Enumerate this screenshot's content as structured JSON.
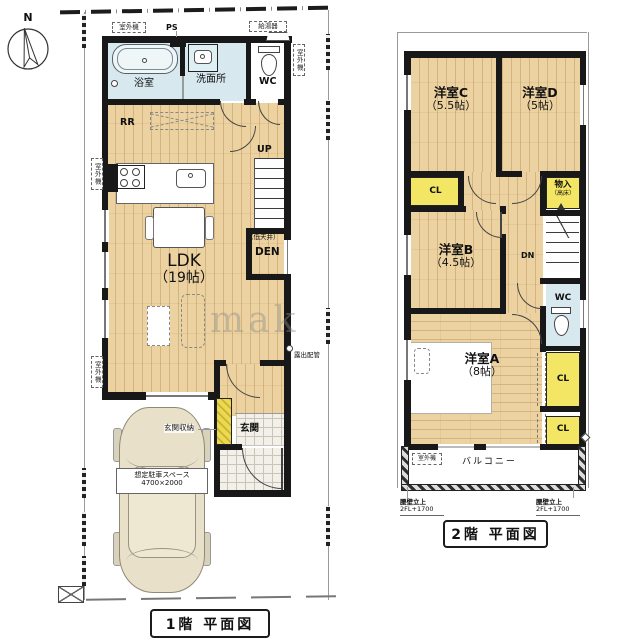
{
  "compass": {
    "north_label": "N"
  },
  "watermark": "mak",
  "colors": {
    "wall": "#181818",
    "wood_floor": "#ecd2a0",
    "wet_area": "#d7e9ef",
    "closet": "#f3e664",
    "tile": "#f2f0e8"
  },
  "floor1": {
    "title": "1階 平面図",
    "rooms": {
      "bath": "浴室",
      "washroom": "洗面所",
      "wc": "WC",
      "ldk_line1": "LDK",
      "ldk_line2": "（19帖）",
      "den": "DEN",
      "den_note": "（低天井）",
      "rr": "RR",
      "up": "UP",
      "genkan": "玄関",
      "genkan_storage": "玄関収納"
    },
    "annotations": {
      "ps": "PS",
      "water_heater": "給湯器",
      "outdoor_unit": "室外機",
      "exposed_pipe": "露出配管",
      "parking_line1": "想定駐車スペース",
      "parking_line2": "4700×2000"
    }
  },
  "floor2": {
    "title": "2階 平面図",
    "rooms": {
      "room_c_line1": "洋室C",
      "room_c_line2": "（5.5帖）",
      "room_d_line1": "洋室D",
      "room_d_line2": "（5帖）",
      "room_b_line1": "洋室B",
      "room_b_line2": "（4.5帖）",
      "room_a_line1": "洋室A",
      "room_a_line2": "（8帖）",
      "cl": "CL",
      "storage_line1": "物入",
      "storage_line2": "（高床）",
      "wc": "WC",
      "dn": "DN",
      "balcony": "バルコニー"
    },
    "annotations": {
      "outdoor_unit": "室外機",
      "parapet_line1": "腰壁立上",
      "parapet_line2": "2FL+1700"
    }
  }
}
